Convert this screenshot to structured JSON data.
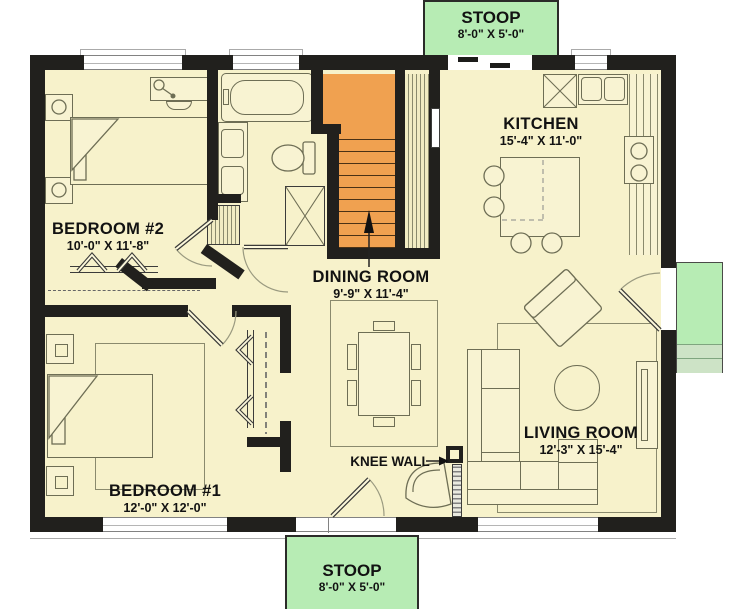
{
  "plan": {
    "rooms": [
      {
        "name": "KITCHEN",
        "dims": "15'-4\" X 11'-0\""
      },
      {
        "name": "BEDROOM #2",
        "dims": "10'-0\" X 11'-8\""
      },
      {
        "name": "DINING ROOM",
        "dims": "9'-9\" X 11'-4\""
      },
      {
        "name": "BEDROOM #1",
        "dims": "12'-0\" X 12'-0\""
      },
      {
        "name": "LIVING ROOM",
        "dims": "12'-3\" X 15'-4\""
      }
    ],
    "stoop_top": {
      "name": "STOOP",
      "dims": "8'-0\" X 5'-0\""
    },
    "stoop_bottom": {
      "name": "STOOP",
      "dims": "8'-0\" X 5'-0\""
    },
    "knee_wall_label": "KNEE WALL",
    "stair_direction": "up-arrow",
    "colors": {
      "floor": "#f7f2cb",
      "wall": "#21201d",
      "stoop_green": "#b7ecb4",
      "stoop_steps": "#cde3c6",
      "stairs_orange": "#f0a150",
      "furniture_line": "#6e6e55",
      "text": "#121212"
    }
  }
}
